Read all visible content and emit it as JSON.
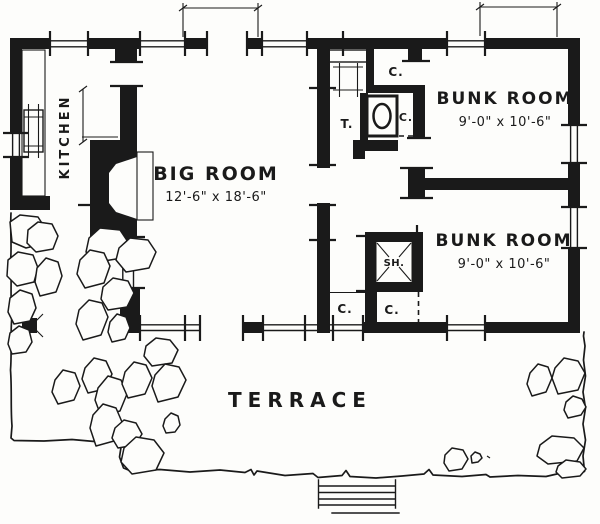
{
  "plan": {
    "rooms": {
      "kitchen": {
        "label": "KITCHEN"
      },
      "big_room": {
        "label": "BIG ROOM",
        "dimensions": "12'-6\" x 18'-6\""
      },
      "bunk_room_top": {
        "label": "BUNK ROOM",
        "dimensions": "9'-0\" x 10'-6\""
      },
      "bunk_room_bottom": {
        "label": "BUNK ROOM",
        "dimensions": "9'-0\" x 10'-6\""
      },
      "terrace": {
        "label": "TERRACE"
      },
      "toilet": {
        "label": "T."
      },
      "shower": {
        "label": "SH."
      },
      "closet_bath_top": {
        "label": "C."
      },
      "closet_bath_side": {
        "label": "C."
      },
      "closet_hall_left": {
        "label": "C."
      },
      "closet_hall_right": {
        "label": "C."
      }
    },
    "colors": {
      "ink": "#1a1a1a",
      "paper": "#fdfdfb"
    }
  }
}
